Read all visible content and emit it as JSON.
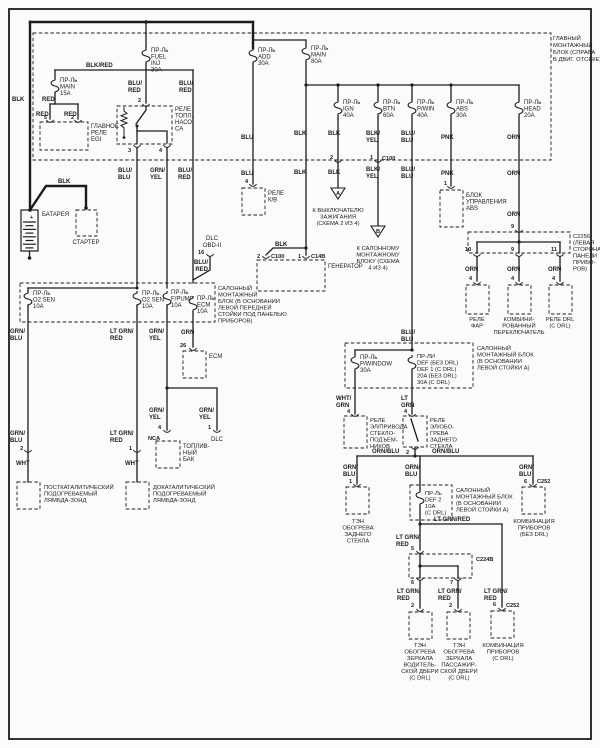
{
  "colors": {
    "ink": "#1c1c1c",
    "paper": "#fbfbf9"
  },
  "main_fusebox": {
    "label": [
      "ГЛАВНЫЙ",
      "МОНТАЖНЫЙ",
      "БЛОК (СПРАВА",
      "В ДВИГ. ОТСЕКЕ)"
    ],
    "fuses": {
      "fuel_inj": [
        "ПР-Ль",
        "FUEL",
        "INJ",
        "30A"
      ],
      "add": [
        "ПР-Ль",
        "ADD",
        "30A"
      ],
      "main80": [
        "ПР-Ль",
        "MAIN",
        "80A"
      ],
      "main15": [
        "ПР-Ль",
        "MAIN",
        "15A"
      ],
      "ign": [
        "ПР-Ль",
        "IGN",
        "40A"
      ],
      "btn": [
        "ПР-Ль",
        "BTN",
        "60A"
      ],
      "pwin": [
        "ПР-Ль",
        "P/WIN",
        "40A"
      ],
      "abs": [
        "ПР-Ль",
        "ABS",
        "30A"
      ],
      "head": [
        "ПР-Ль",
        "HEAD",
        "20A"
      ]
    }
  },
  "cabin_fusebox1": {
    "label": [
      "САЛОННЫЙ",
      "МОНТАЖНЫЙ",
      "БЛОК (В ОСНОВАНИИ",
      "ЛЕВОЙ ПЕРЕДНЕЙ",
      "СТОЙКИ ПОД ПАНЕЛЬЮ",
      "ПРИБОРОВ)"
    ],
    "fuses": {
      "o2_sen_1": [
        "ПР-Ль",
        "O2 SEN",
        "10A"
      ],
      "o2_sen_2": [
        "ПР-Ль",
        "O2 SEN",
        "10A"
      ],
      "f_pump": [
        "ПР-Ль",
        "F/PUMP",
        "10A"
      ],
      "ecm": [
        "ПР-Ль",
        "ECM",
        "10A"
      ]
    }
  },
  "cabin_fusebox2": {
    "label": [
      "САЛОННЫЙ",
      "МОНТАЖНЫЙ БЛОК",
      "(В ОСНОВАНИИ",
      "ЛЕВОЙ СТОЙКИ A)"
    ],
    "fuses": {
      "p_window": [
        "ПР-Ль",
        "P/WINDOW",
        "30A"
      ],
      "def": [
        "ПР-ЛИ",
        "DEF (БЕЗ DRL)",
        "DEF 1 (С DRL)",
        "20A (БЕЗ DRL)",
        "30A (С DRL)"
      ]
    }
  },
  "cabin_fusebox3": {
    "label": [
      "САЛОННЫЙ",
      "МОНТАЖНЫЙ БЛОК",
      "(В ОСНОВАНИИ",
      "ЛЕВОЙ СТОЙКИ A)"
    ],
    "fuses": {
      "def2": [
        "ПР-Ль",
        "DEF 2",
        "10A",
        "(С DRL)"
      ]
    }
  },
  "components": {
    "battery": "БАТАРЕЯ",
    "starter": "СТАРТЕР",
    "generator": "ГЕНЕРАТОР",
    "egi_relay": [
      "ГЛАВНОЕ",
      "РЕЛЕ",
      "EGI"
    ],
    "fuel_pump_relay": [
      "РЕЛЕ",
      "ТОПЛ.",
      "НАСО-",
      "СА"
    ],
    "ac_relay": [
      "РЕЛЕ",
      "К/В"
    ],
    "abs_unit": [
      "БЛОК",
      "УПРАВЛЕНИЯ",
      "ABS"
    ],
    "headlight_relay": [
      "РЕЛЕ",
      "ФАР"
    ],
    "combo_switch": [
      "КОМБИНИ-",
      "РОВАННЫЙ",
      "ПЕРЕКЛЮЧАТЕЛЬ"
    ],
    "drl_relay": [
      "РЕЛЕ DRL",
      "(С DRL)"
    ],
    "pw_relay": [
      "РЕЛЕ",
      "ЭЛ/ПРИВОДА",
      "СТЕКЛО-",
      "ПОДЪЕМ-",
      "НИКОВ"
    ],
    "defog_relay": [
      "РЕЛЕ",
      "ЭЛ/ОБО-",
      "ГРЕВА",
      "ЗАДНЕГО",
      "СТЕКЛА"
    ],
    "rear_glass_heater": [
      "ТЭН",
      "ОБОГРЕВА",
      "ЗАДНЕГО",
      "СТЕКЛА"
    ],
    "cluster_no_drl": [
      "КОМБИНАЦИЯ",
      "ПРИБОРОВ",
      "(БЕЗ DRL)"
    ],
    "cluster_drl": [
      "КОМБИНАЦИЯ",
      "ПРИБОРОВ",
      "(С DRL)"
    ],
    "mirror_heater_driver": [
      "ТЭН",
      "ОБОГРЕВА",
      "ЗЕРКАЛА",
      "ВОДИТЕЛЬ-",
      "СКОЙ ДВЕРИ",
      "(С DRL)"
    ],
    "mirror_heater_passenger": [
      "ТЭН",
      "ОБОГРЕВА",
      "ЗЕРКАЛА",
      "ПАССАЖИР-",
      "СКОЙ ДВЕРИ",
      "(С DRL)"
    ],
    "ecm": "ECM",
    "dlc_obd": [
      "DLC",
      "OBD-II"
    ],
    "dlc": "DLC",
    "fuel_tank": [
      "ТОПЛИВ-",
      "НЫЙ",
      "БАК"
    ],
    "lambda_post": [
      "ПОСТКАТАЛИТИЧЕСКИЙ",
      "ПОДОГРЕВАЕМЫЙ",
      "ЛЯМБДА-ЗОНД"
    ],
    "lambda_pre": [
      "ДОКАТАЛИТИЧЕСКИЙ",
      "ПОДОГРЕВАЕМЫЙ",
      "ЛЯМБДА-ЗОНД"
    ]
  },
  "notes": {
    "to_ignition": [
      "К ВЫКЛЮЧАТЕЛЮ",
      "ЗАЖИГАНИЯ",
      "(СХЕМА 2 ИЗ 4)"
    ],
    "to_cabin_block": [
      "К САЛОННОМУ",
      "МОНТАЖНОМУ",
      "БЛОКУ (СХЕМА",
      "4 ИЗ 4)"
    ]
  },
  "connectors": {
    "c100": "C100",
    "c14b": "C14B",
    "c2256": [
      "C2256",
      "(ЛЕВАЯ",
      "СТОРОНА",
      "ПАНЕЛИ",
      "ПРИБО-",
      "РОВ)"
    ],
    "c224b": "C224B",
    "c252": "C252"
  },
  "pins": {
    "p1": "1",
    "p2": "2",
    "p3": "3",
    "p4": "4",
    "p5": "5",
    "p6": "6",
    "p7": "7",
    "p9": "9",
    "p10": "10",
    "p11": "11",
    "p16": "16",
    "p26": "26",
    "nca": "NCA"
  },
  "wire_colors": {
    "blk": "BLK",
    "red": "RED",
    "blu": "BLU",
    "pnk": "PNK",
    "orn": "ORN",
    "grn": "GRN",
    "wht": "WHT",
    "blk_red": "BLK/RED",
    "blu_red": [
      "BLU/",
      "RED"
    ],
    "blu_blu": [
      "BLU/",
      "BLU"
    ],
    "grn_yel": [
      "GRN/",
      "YEL"
    ],
    "blk_yel": [
      "BLK/",
      "YEL"
    ],
    "grn_blu": [
      "GRN/",
      "BLU"
    ],
    "lt_grn_red": [
      "LT GRN/",
      "RED"
    ],
    "lt_grn_red_inline": "LT GRN/RED",
    "orn_blu": [
      "ORN/",
      "BLU"
    ],
    "orn_blu_inline": "ORN/BLU",
    "wht_grn": [
      "WHT/",
      "GRN"
    ],
    "lt_grn": [
      "LT",
      "GRN"
    ]
  },
  "symbols": {
    "triangle_a": "A",
    "triangle_b": "B",
    "battery_plus": "+"
  }
}
